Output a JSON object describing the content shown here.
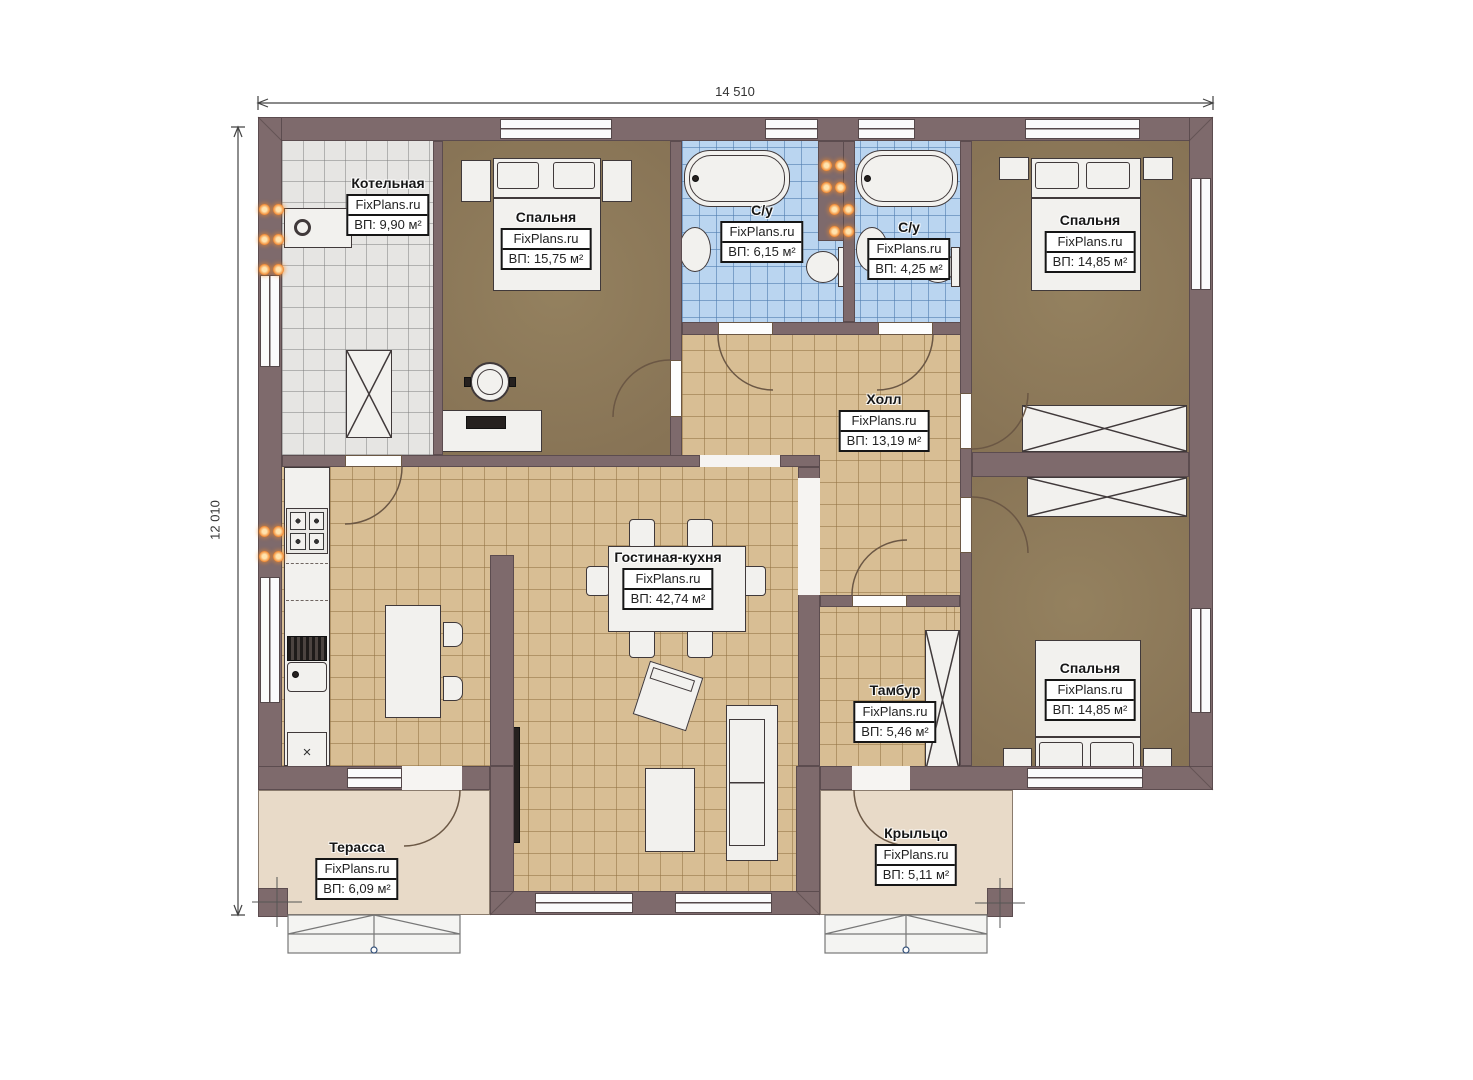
{
  "dimensions": {
    "width_label": "14 510",
    "height_label": "12 010"
  },
  "rooms": [
    {
      "name": "Котельная",
      "site": "FixPlans.ru",
      "area": "ВП: 9,90 м²"
    },
    {
      "name": "Спальня",
      "site": "FixPlans.ru",
      "area": "ВП: 15,75 м²"
    },
    {
      "name": "С/у",
      "site": "FixPlans.ru",
      "area": "ВП: 6,15 м²"
    },
    {
      "name": "С/у",
      "site": "FixPlans.ru",
      "area": "ВП: 4,25 м²"
    },
    {
      "name": "Спальня",
      "site": "FixPlans.ru",
      "area": "ВП: 14,85 м²"
    },
    {
      "name": "Холл",
      "site": "FixPlans.ru",
      "area": "ВП: 13,19 м²"
    },
    {
      "name": "Гостиная-кухня",
      "site": "FixPlans.ru",
      "area": "ВП: 42,74 м²"
    },
    {
      "name": "Тамбур",
      "site": "FixPlans.ru",
      "area": "ВП: 5,46 м²"
    },
    {
      "name": "Спальня",
      "site": "FixPlans.ru",
      "area": "ВП: 14,85 м²"
    },
    {
      "name": "Терасса",
      "site": "FixPlans.ru",
      "area": "ВП: 6,09 м²"
    },
    {
      "name": "Крыльцо",
      "site": "FixPlans.ru",
      "area": "ВП: 5,11 м²"
    }
  ],
  "symbols": {
    "dishwasher": "×"
  },
  "colors": {
    "wall": "#7e6a6c",
    "tile_tan": "#d8be94",
    "tile_gray": "#e6e5e3",
    "tile_blue": "#bad5f0",
    "floor_brown": "#8d7a5b",
    "outdoor": "#e8dac8",
    "radiator": "#f08228"
  }
}
